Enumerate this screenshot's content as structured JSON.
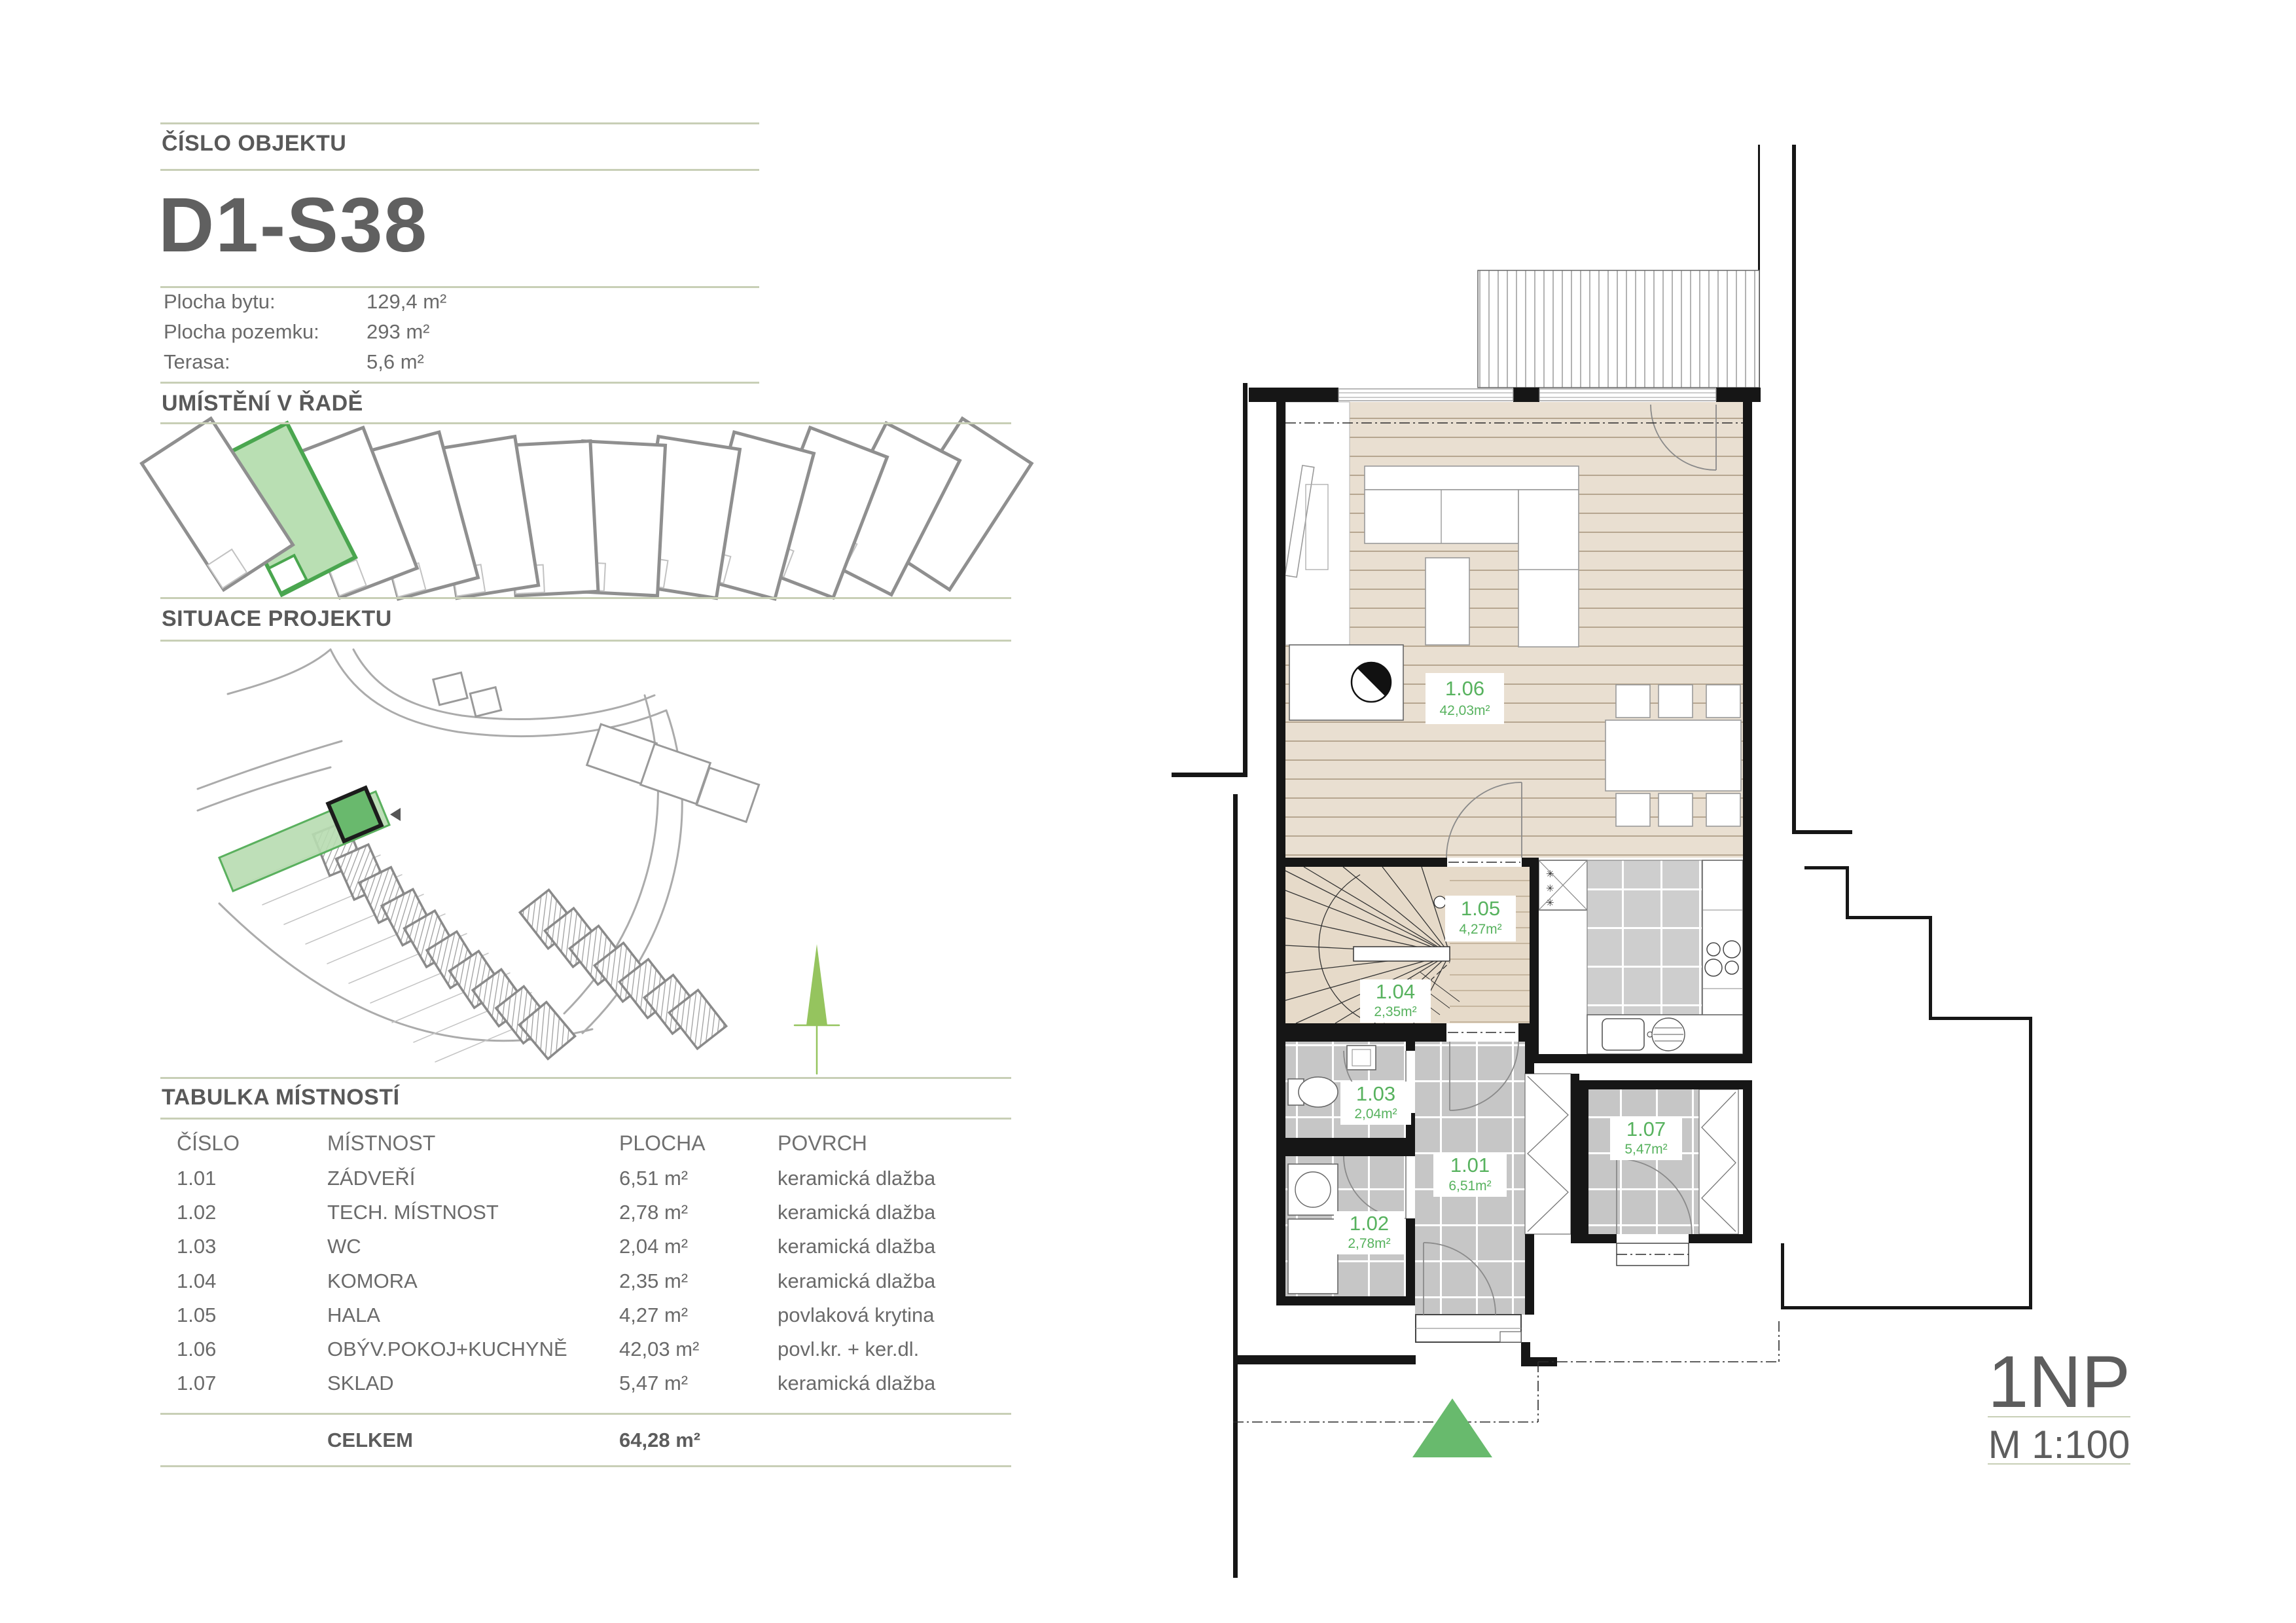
{
  "colors": {
    "accent_green": "#57b25e",
    "divider": "#c8cfb6",
    "heading_gray": "#595959",
    "body_gray": "#6a6a6a",
    "plot_green": "#69b96d",
    "wood_floor": "#e9dfd1",
    "tile_gray": "#c6c6c6"
  },
  "panel": {
    "object_number_label": "ČÍSLO OBJEKTU",
    "object_number": "D1-S38",
    "details": [
      {
        "label": "Plocha bytu:",
        "value": "129,4 m²"
      },
      {
        "label": "Plocha pozemku:",
        "value": "293 m²"
      },
      {
        "label": "Terasa:",
        "value": "5,6 m²"
      }
    ],
    "row_section_title": "UMÍSTĚNÍ V ŘADĚ",
    "situation_section_title": "SITUACE PROJEKTU",
    "table_section_title": "TABULKA MÍSTNOSTÍ",
    "table": {
      "headers": [
        "ČÍSLO",
        "MÍSTNOST",
        "PLOCHA",
        "POVRCH"
      ],
      "rows": [
        {
          "cislo": "1.01",
          "mistnost": "ZÁDVEŘÍ",
          "plocha": "6,51 m²",
          "povrch": "keramická dlažba"
        },
        {
          "cislo": "1.02",
          "mistnost": "TECH. MÍSTNOST",
          "plocha": "2,78 m²",
          "povrch": "keramická dlažba"
        },
        {
          "cislo": "1.03",
          "mistnost": "WC",
          "plocha": "2,04 m²",
          "povrch": "keramická dlažba"
        },
        {
          "cislo": "1.04",
          "mistnost": "KOMORA",
          "plocha": "2,35 m²",
          "povrch": "keramická dlažba"
        },
        {
          "cislo": "1.05",
          "mistnost": "HALA",
          "plocha": "4,27 m²",
          "povrch": "povlaková krytina"
        },
        {
          "cislo": "1.06",
          "mistnost": "OBÝV.POKOJ+KUCHYNĚ",
          "plocha": "42,03 m²",
          "povrch": "povl.kr. + ker.dl."
        },
        {
          "cislo": "1.07",
          "mistnost": "SKLAD",
          "plocha": "5,47 m²",
          "povrch": "keramická dlažba"
        }
      ],
      "total_label": "CELKEM",
      "total_value": "64,28 m²"
    }
  },
  "plan": {
    "floor_label": "1NP",
    "scale_label": "M 1:100",
    "rooms": [
      {
        "id": "1.01",
        "area": "6,51m²"
      },
      {
        "id": "1.02",
        "area": "2,78m²"
      },
      {
        "id": "1.03",
        "area": "2,04m²"
      },
      {
        "id": "1.04",
        "area": "2,35m²"
      },
      {
        "id": "1.05",
        "area": "4,27m²"
      },
      {
        "id": "1.06",
        "area": "42,03m²"
      },
      {
        "id": "1.07",
        "area": "5,47m²"
      }
    ]
  }
}
